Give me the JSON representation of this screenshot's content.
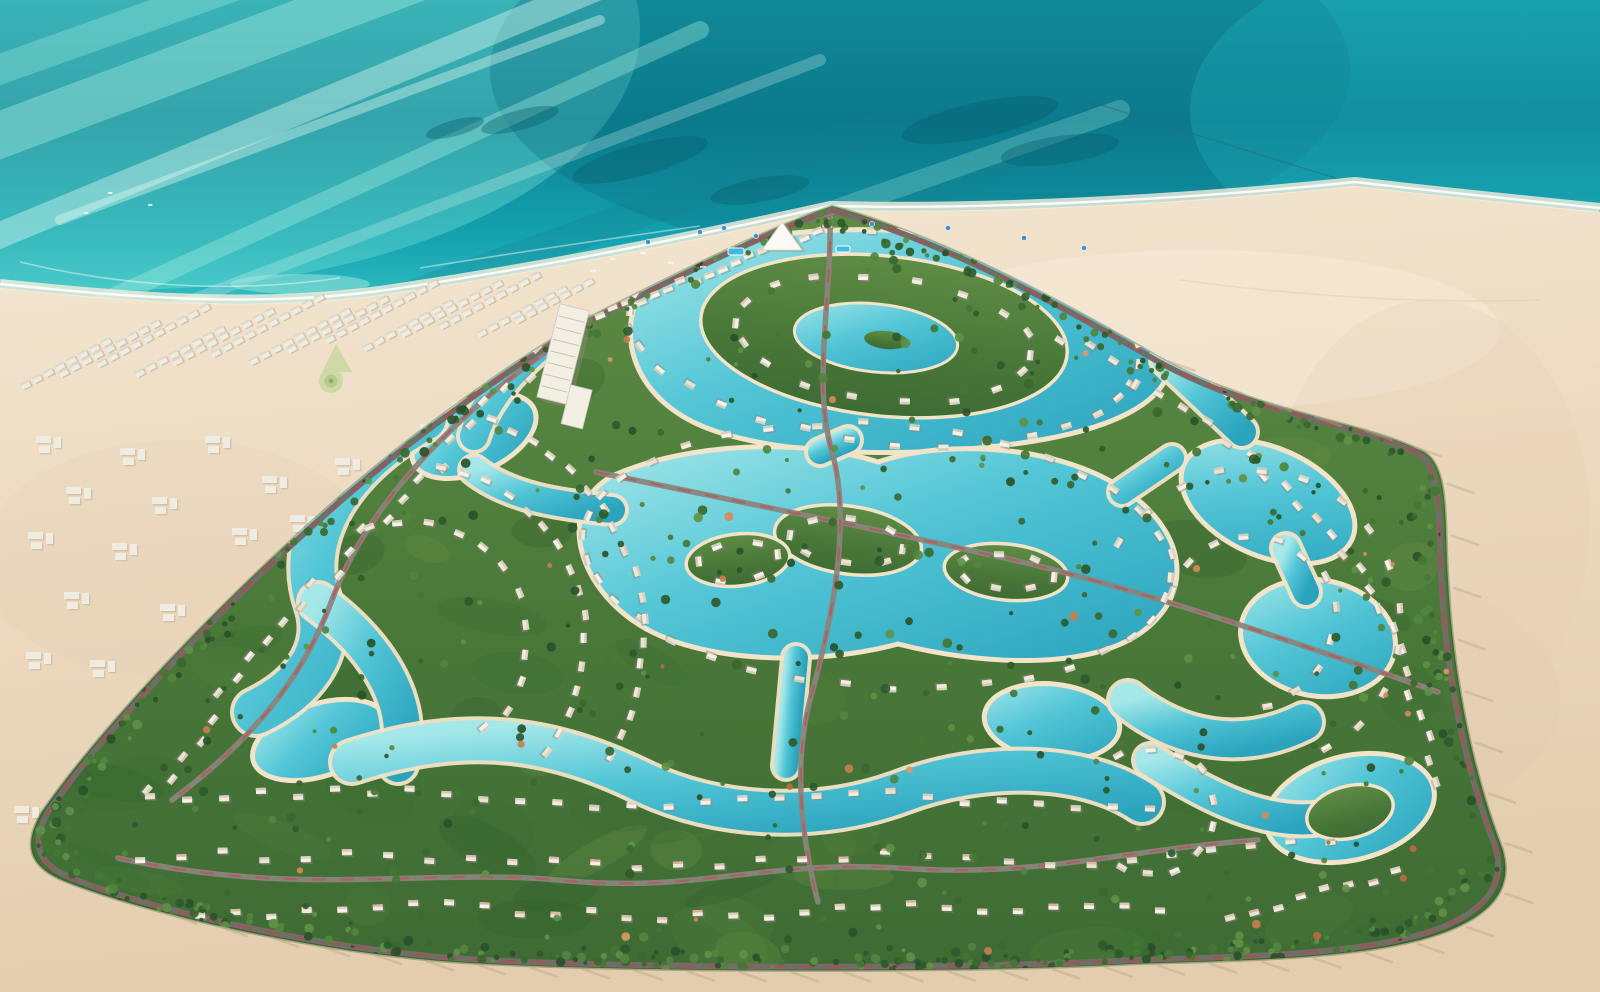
{
  "palette": {
    "sea_top": "#1697a3",
    "sea_deep": "#0c8093",
    "sea_mid": "#14a3b0",
    "sea_bright": "#3fc6c9",
    "sea_pale": "#a5ecdc",
    "sea_palest": "#c8f4e6",
    "sea_streak_light": "#aef3e2",
    "sea_streak_white": "#e4fdf4",
    "sea_streak_dark": "#157f8e",
    "reef": "#07606f",
    "shallow": "#9fe9dc",
    "foam": "#ffffff",
    "cable": "#2e6a74",
    "sand_light": "#f4e7d2",
    "sand_mid": "#ecd9bf",
    "sand_deep": "#e3cdae",
    "sand_wet": "#f8efdc",
    "lagoon_light": "#a5e8e9",
    "lagoon_mid": "#52c5d6",
    "lagoon_deep": "#2aa3bd",
    "lagoon_rim": "#f2e4c8",
    "green_light": "#5f8d46",
    "green_mid": "#4a7839",
    "green_dark": "#3e6b33",
    "green_edge": "#2f5429",
    "mottle": [
      "#3a6a33",
      "#52803c",
      "#2f5c2c",
      "#6a9347"
    ],
    "tree_palette": [
      "#2e5a2b",
      "#39682f",
      "#447636",
      "#518540",
      "#2a512a",
      "#5e9147"
    ],
    "tree_accent": [
      "#c87e4f",
      "#d28b57",
      "#b96a43",
      "#d99a62"
    ],
    "villa_body": [
      "#f6f2e9",
      "#efe8da",
      "#ece2d2",
      "#f2ece0"
    ],
    "villa_roof": [
      "#d7cfc0",
      "#cfc6b5",
      "#ddc8b8"
    ],
    "villa_roof_pink": [
      "#d8a9a0",
      "#cbb49a",
      "#dcb3a6"
    ],
    "villa_shadow": "#8e887c",
    "road_grey": "#8b847c",
    "road_red": "#b4575b",
    "perimeter_grey": "#726d66",
    "perimeter_red": "#a84f52",
    "car_dark": "#3a3a3a",
    "chalet": "#f0ece1",
    "chalet_shadow": "#b7ab96",
    "chalet_roof": "#dcd6c8",
    "pool_blue": "#41bce2",
    "umbrella_blue": "#3f8fd2",
    "landmark_white": "#f4efe5",
    "palm_shadow": "#b9a284",
    "tide_mark": "#e3cfb2"
  },
  "scene": {
    "size": {
      "w": 1600,
      "h": 992
    },
    "sea": {
      "rect": [
        0,
        0,
        1600,
        480
      ],
      "glow_patches": [
        [
          120,
          30,
          520,
          260,
          "#7fe9d9",
          0.35
        ],
        [
          920,
          70,
          430,
          190,
          "#0a6e80",
          0.32
        ],
        [
          1510,
          110,
          320,
          170,
          "#21b6c2",
          0.3
        ]
      ],
      "streaks": [
        [
          -40,
          150,
          520,
          -60,
          46,
          "light",
          0.38
        ],
        [
          -60,
          260,
          640,
          -30,
          26,
          "white",
          0.4
        ],
        [
          40,
          330,
          700,
          30,
          18,
          "light",
          0.35
        ],
        [
          -30,
          80,
          420,
          -80,
          30,
          "light",
          0.3
        ],
        [
          140,
          320,
          820,
          60,
          12,
          "white",
          0.25
        ],
        [
          230,
          360,
          900,
          120,
          30,
          "dark",
          0.25
        ],
        [
          60,
          220,
          600,
          20,
          10,
          "white",
          0.4
        ],
        [
          420,
          380,
          1050,
          140,
          36,
          "dark",
          0.22
        ],
        [
          520,
          320,
          1120,
          110,
          20,
          "light",
          0.25
        ]
      ],
      "reefs": [
        [
          640,
          160,
          70,
          16,
          -15
        ],
        [
          760,
          190,
          50,
          12,
          -10
        ],
        [
          980,
          120,
          80,
          18,
          -12
        ],
        [
          1060,
          150,
          60,
          14,
          -8
        ],
        [
          880,
          240,
          55,
          12,
          -10
        ],
        [
          1140,
          310,
          70,
          16,
          -14
        ],
        [
          1230,
          350,
          60,
          14,
          -12
        ],
        [
          520,
          120,
          40,
          10,
          -15
        ],
        [
          455,
          128,
          30,
          8,
          -15
        ],
        [
          1010,
          320,
          40,
          10,
          -10
        ]
      ],
      "shallows": [
        [
          600,
          302,
          90,
          12
        ],
        [
          300,
          284,
          70,
          10
        ],
        [
          1050,
          330,
          80,
          10
        ],
        [
          820,
          300,
          60,
          9
        ]
      ],
      "boats": [
        [
          108,
          192
        ],
        [
          148,
          204
        ],
        [
          84,
          212
        ]
      ],
      "cable": [
        1085,
        100,
        1380,
        192
      ],
      "offshore_foam": [
        "M 20 262 C 120 286 230 294 340 278",
        "M 420 268 C 520 252 600 240 700 226"
      ]
    },
    "shore": {
      "sand_path": "M 0 288 C 120 300 260 314 400 292 C 520 274 640 252 830 210 C 1000 214 1200 202 1355 186 C 1460 198 1560 208 1600 212 L 1600 992 L 0 992 Z",
      "water_line": "M 0 284 C 120 296 260 310 400 288 C 520 270 640 248 830 206 C 1000 210 1200 198 1355 182 C 1460 194 1560 204 1600 208",
      "sand_patches": [
        [
          1300,
          700,
          260,
          140,
          "#dfc9ad",
          0.22
        ],
        [
          180,
          560,
          200,
          120,
          "#dfc9ad",
          0.18
        ],
        [
          1200,
          330,
          300,
          80,
          "#f7ecd9",
          0.5
        ],
        [
          1430,
          520,
          160,
          220,
          "#e8d2b6",
          0.3
        ]
      ],
      "tide_marks": [
        "M 1180 280 C 1300 296 1420 304 1540 300"
      ]
    },
    "development": {
      "outline": "M 832 206 C 940 236 1060 300 1160 358 C 1260 414 1360 420 1424 452 C 1450 468 1444 520 1448 580 C 1452 660 1468 760 1502 848 C 1514 886 1494 912 1450 930 C 1376 960 1240 960 1130 964 C 950 974 560 972 430 960 C 300 948 140 912 62 880 C 30 866 22 846 42 812 C 120 700 300 520 430 424 C 500 372 556 334 608 308 C 680 272 760 232 832 206 Z",
      "poly": [
        [
          832,
          206
        ],
        [
          1160,
          358
        ],
        [
          1424,
          452
        ],
        [
          1468,
          740
        ],
        [
          1504,
          856
        ],
        [
          1450,
          930
        ],
        [
          1130,
          964
        ],
        [
          430,
          960
        ],
        [
          62,
          880
        ],
        [
          42,
          812
        ],
        [
          430,
          424
        ],
        [
          608,
          308
        ]
      ],
      "centroid": [
        780,
        600
      ],
      "mottle_count": 70
    },
    "lagoons": {
      "blobs": [
        "M 636 302 C 650 258 752 226 882 230 C 1024 234 1152 292 1168 352 C 1180 402 1106 432 1014 444 C 926 456 798 458 718 432 C 642 408 618 348 636 302 Z",
        "M 612 476 C 688 442 804 438 878 462 C 948 438 1058 446 1122 488 C 1186 530 1196 592 1142 632 C 1086 672 976 664 898 644 C 816 666 700 664 638 624 C 576 584 556 508 612 476 Z"
      ],
      "ellipses": [
        [
          474,
          436,
          66,
          36,
          -24
        ],
        [
          1268,
          502,
          92,
          54,
          24
        ],
        [
          1318,
          638,
          78,
          58,
          10
        ],
        [
          1052,
          722,
          68,
          38,
          6
        ],
        [
          320,
          740,
          70,
          36,
          -18
        ],
        [
          1350,
          808,
          86,
          52,
          -14
        ]
      ],
      "channels": [
        [
          "M 424 418 C 330 470 298 544 318 602 C 336 654 298 692 256 712",
          44
        ],
        [
          "M 318 602 C 372 642 416 700 398 764",
          36
        ],
        [
          "M 352 762 C 474 722 560 742 642 782 C 722 820 822 822 902 792 C 982 762 1082 762 1142 802",
          40
        ],
        [
          "M 1128 700 C 1180 742 1244 752 1304 722",
          36
        ],
        [
          "M 1150 760 C 1210 798 1266 826 1322 818",
          30
        ],
        [
          "M 820 452 L 848 440",
          24
        ],
        [
          "M 796 658 L 786 766",
          24
        ],
        [
          "M 1122 492 L 1172 458",
          24
        ],
        [
          "M 1166 360 L 1242 432",
          28
        ],
        [
          "M 560 330 C 520 360 486 396 474 436",
          28
        ],
        [
          "M 1286 548 L 1306 592",
          26
        ],
        [
          "M 612 510 C 560 505 510 498 474 470",
          26
        ]
      ],
      "islands": [
        [
          884,
          336,
          184,
          80,
          6
        ],
        [
          848,
          540,
          74,
          34,
          8
        ],
        [
          1006,
          572,
          62,
          28,
          6
        ],
        [
          738,
          560,
          52,
          26,
          -6
        ],
        [
          1350,
          812,
          44,
          26,
          -14
        ]
      ],
      "inner_ponds": [
        [
          876,
          338,
          82,
          34,
          6
        ]
      ],
      "islets": [
        [
          886,
          340,
          22,
          9,
          6
        ]
      ]
    },
    "roads": {
      "internal": [
        "M 596 472 C 760 506 900 534 1022 562 C 1142 590 1300 644 1438 692",
        "M 830 214 C 832 300 812 382 832 452 C 852 522 832 622 810 700 C 794 762 800 832 818 902",
        "M 118 858 C 300 898 420 868 558 880 C 698 894 758 860 898 868 C 1038 878 1120 850 1258 840",
        "M 560 342 C 432 430 362 520 332 600 C 302 680 252 740 172 800",
        "M 588 300 C 700 252 780 226 834 212"
      ],
      "car_fractions": [
        0.12,
        0.2,
        0.33,
        0.47,
        0.62,
        0.85
      ]
    },
    "villas": {
      "lines": [
        {
          "pts": [
            [
              600,
              316
            ],
            [
              830,
              224
            ]
          ],
          "n": 18,
          "j": 4
        },
        {
          "pts": [
            [
              560,
              336
            ],
            [
              340,
              560
            ],
            [
              150,
              792
            ]
          ],
          "n": 26,
          "j": 10
        },
        {
          "pts": [
            [
              1064,
              334
            ],
            [
              1260,
              460
            ],
            [
              1380,
              600
            ],
            [
              1442,
              780
            ]
          ],
          "n": 26,
          "j": 8
        },
        {
          "pts": [
            [
              150,
              800
            ],
            [
              400,
              792
            ],
            [
              650,
              806
            ],
            [
              900,
              796
            ],
            [
              1150,
              806
            ]
          ],
          "n": 28,
          "j": 6
        },
        {
          "pts": [
            [
              140,
              858
            ],
            [
              380,
              852
            ],
            [
              620,
              866
            ],
            [
              860,
              856
            ],
            [
              1100,
              862
            ],
            [
              1330,
              838
            ]
          ],
          "n": 30,
          "j": 6,
          "pink": true
        },
        {
          "pts": [
            [
              200,
              914
            ],
            [
              440,
              906
            ],
            [
              680,
              918
            ],
            [
              920,
              908
            ],
            [
              1160,
              912
            ]
          ],
          "n": 28,
          "j": 6,
          "pink": true
        },
        {
          "pts": [
            [
              1230,
              918
            ],
            [
              1396,
              872
            ]
          ],
          "n": 8,
          "j": 4,
          "pink": true
        }
      ],
      "rings": [
        {
          "c": [
            885,
            336
          ],
          "rx": 258,
          "ry": 106,
          "rot": 6,
          "n": 34,
          "a0": 0,
          "a1": 360
        },
        {
          "c": [
            884,
            338
          ],
          "rx": 150,
          "ry": 62,
          "rot": 6,
          "n": 18,
          "a0": 0,
          "a1": 360
        },
        {
          "c": [
            878,
            556
          ],
          "rx": 296,
          "ry": 132,
          "rot": 4,
          "n": 38,
          "a0": 0,
          "a1": 360
        },
        {
          "c": [
            848,
            540
          ],
          "rx": 56,
          "ry": 24,
          "rot": 8,
          "n": 8,
          "a0": 0,
          "a1": 360
        },
        {
          "c": [
            1006,
            572
          ],
          "rx": 46,
          "ry": 20,
          "rot": 6,
          "n": 7,
          "a0": 0,
          "a1": 360
        },
        {
          "c": [
            738,
            560
          ],
          "rx": 40,
          "ry": 20,
          "rot": -6,
          "n": 6,
          "a0": 0,
          "a1": 360
        },
        {
          "c": [
            410,
            640
          ],
          "rx": 118,
          "ry": 118,
          "rot": 0,
          "n": 12,
          "a0": -110,
          "a1": 50
        },
        {
          "c": [
            410,
            640
          ],
          "rx": 176,
          "ry": 176,
          "rot": 0,
          "n": 16,
          "a0": -80,
          "a1": 40
        },
        {
          "c": [
            410,
            640
          ],
          "rx": 234,
          "ry": 234,
          "rot": 0,
          "n": 18,
          "a0": -70,
          "a1": 30
        },
        {
          "c": [
            1250,
            620
          ],
          "rx": 86,
          "ry": 86,
          "rot": 0,
          "n": 12,
          "a0": -160,
          "a1": 80
        },
        {
          "c": [
            1250,
            620
          ],
          "rx": 150,
          "ry": 150,
          "rot": 0,
          "n": 14,
          "a0": -150,
          "a1": 60
        },
        {
          "c": [
            1152,
            812
          ],
          "rx": 64,
          "ry": 64,
          "rot": 0,
          "n": 10,
          "a0": -120,
          "a1": 120
        }
      ]
    },
    "trees": {
      "interior": 360,
      "perimeter": 400,
      "accent": 30,
      "bottom_row": 80,
      "bottom_row_pts": [
        [
          80,
          886
        ],
        [
          430,
          956
        ],
        [
          800,
          964
        ],
        [
          1130,
          958
        ],
        [
          1400,
          930
        ],
        [
          1500,
          868
        ]
      ]
    },
    "offplot": {
      "row_angle": -28,
      "rows": [
        [
          20,
          384,
          104
        ],
        [
          58,
          372,
          118
        ],
        [
          96,
          362,
          128
        ],
        [
          134,
          372,
          110
        ],
        [
          172,
          360,
          120
        ],
        [
          210,
          352,
          126
        ],
        [
          248,
          360,
          112
        ],
        [
          286,
          348,
          120
        ],
        [
          324,
          338,
          126
        ],
        [
          362,
          346,
          110
        ],
        [
          400,
          332,
          118
        ],
        [
          438,
          324,
          122
        ],
        [
          476,
          332,
          104
        ],
        [
          514,
          318,
          96
        ]
      ],
      "clusters": [
        [
          36,
          436
        ],
        [
          120,
          448
        ],
        [
          205,
          436
        ],
        [
          66,
          487
        ],
        [
          152,
          497
        ],
        [
          262,
          476
        ],
        [
          335,
          458
        ],
        [
          28,
          532
        ],
        [
          112,
          543
        ],
        [
          232,
          528
        ],
        [
          290,
          515
        ],
        [
          64,
          592
        ],
        [
          160,
          604
        ],
        [
          26,
          652
        ],
        [
          420,
          424
        ],
        [
          452,
          402
        ],
        [
          14,
          806
        ],
        [
          44,
          828
        ],
        [
          300,
          645
        ],
        [
          90,
          660
        ]
      ],
      "roundabout": [
        331,
        381
      ],
      "triangle": [
        [
          336,
          344
        ],
        [
          352,
          372
        ],
        [
          322,
          372
        ]
      ]
    },
    "landmarks": {
      "hotel": {
        "x": 548,
        "y": 306,
        "w": 30,
        "h": 96,
        "rot": 14,
        "floors": 7,
        "annex": [
          578,
          382,
          22,
          40
        ]
      },
      "tent": [
        [
          782,
          222
        ],
        [
          802,
          250
        ],
        [
          762,
          250
        ]
      ],
      "umbrellas": [
        [
          700,
          232
        ],
        [
          724,
          228
        ],
        [
          756,
          236
        ],
        [
          948,
          228
        ],
        [
          1024,
          238
        ],
        [
          1084,
          248
        ],
        [
          648,
          242
        ],
        [
          872,
          224
        ]
      ],
      "sunbeds": [
        [
          610,
          258
        ],
        [
          640,
          252
        ],
        [
          668,
          262
        ],
        [
          700,
          266
        ],
        [
          590,
          270
        ]
      ],
      "pools": [
        [
          728,
          248,
          16,
          7
        ],
        [
          836,
          246,
          14,
          6
        ]
      ],
      "palm_shadow_dir": [
        26,
        9
      ]
    }
  }
}
